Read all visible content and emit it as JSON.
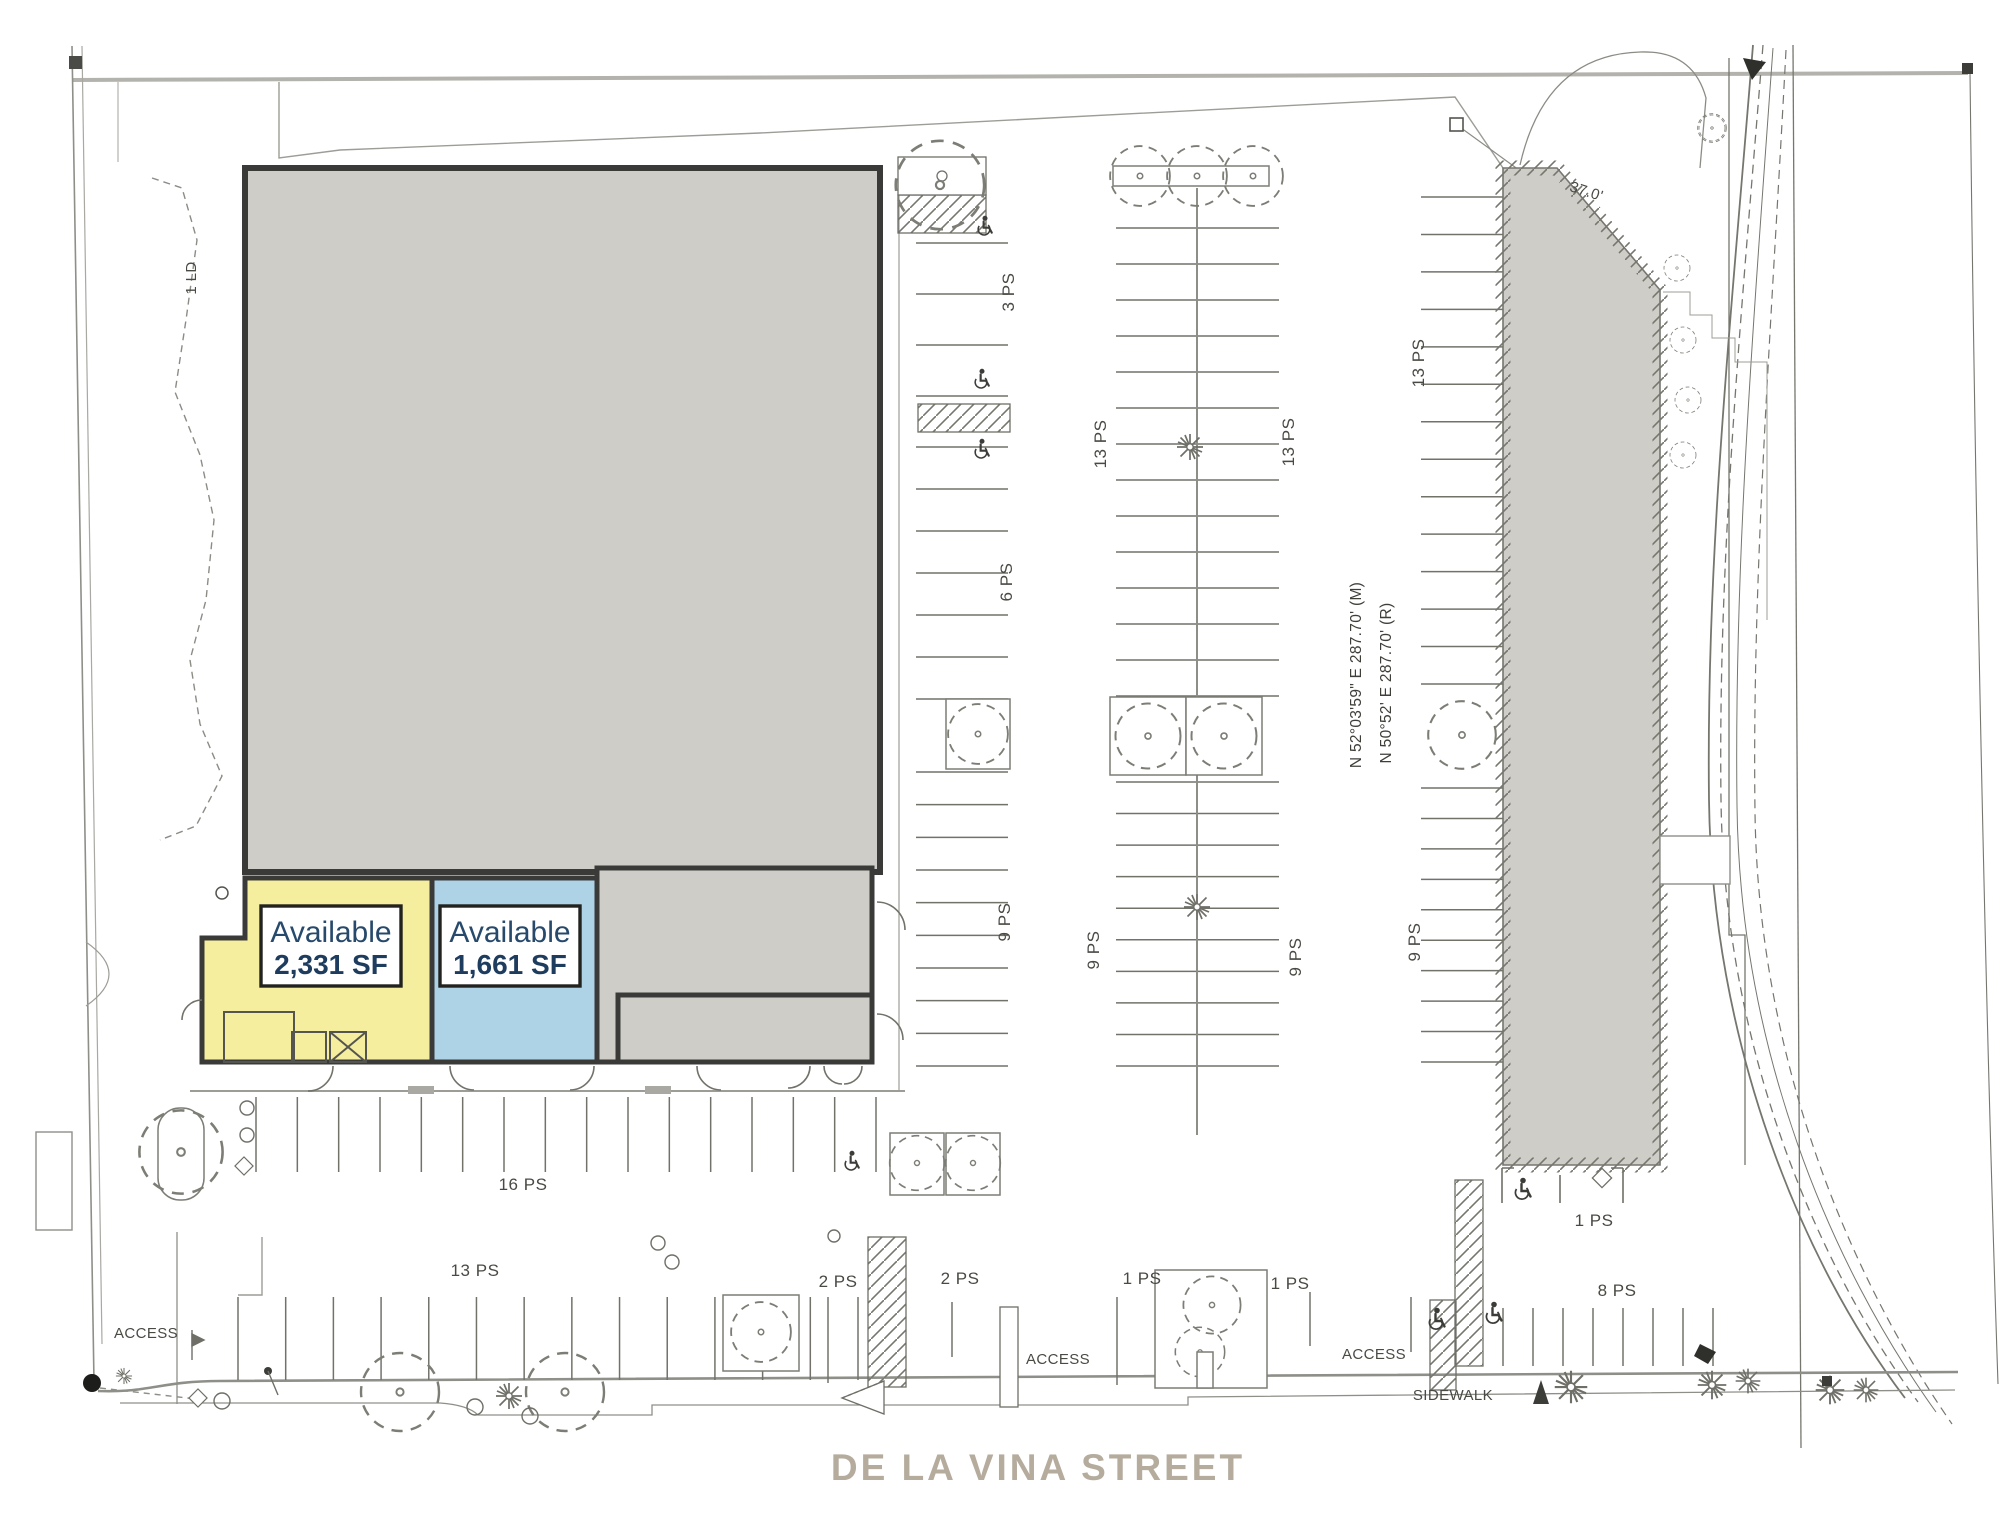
{
  "street": {
    "name": "DE LA VINA STREET"
  },
  "units": [
    {
      "status": "Available",
      "area": "2,331 SF",
      "fill": "#f5ee9f"
    },
    {
      "status": "Available",
      "area": "1,661 SF",
      "fill": "#aed3e6"
    }
  ],
  "survey": {
    "bearing_measured": "N 52°03'59\" E  287.70' (M)",
    "bearing_record": "N 50°52' E  287.70' (R)",
    "dimension": "37.0'",
    "corner_note": "1 LD"
  },
  "parking": {
    "vertical": [
      "3 PS",
      "6 PS",
      "9 PS",
      "13 PS",
      "13 PS",
      "9 PS",
      "9 PS",
      "13 PS",
      "9 PS"
    ],
    "horizontal": [
      "16 PS",
      "13 PS",
      "2 PS",
      "2 PS",
      "1 PS",
      "1 PS",
      "1 PS",
      "8 PS"
    ]
  },
  "labels": {
    "access": [
      "ACCESS",
      "ACCESS",
      "ACCESS"
    ],
    "sidewalk": "SIDEWALK"
  },
  "colors": {
    "building_fill": "#cecdc7",
    "building_wall": "#3a3a38",
    "unit_yellow": "#f5ee9f",
    "unit_blue": "#aed3e6",
    "label_navy": "#1d3c5e",
    "street_text": "#b5ac9e",
    "site_line": "#8f8f89"
  }
}
